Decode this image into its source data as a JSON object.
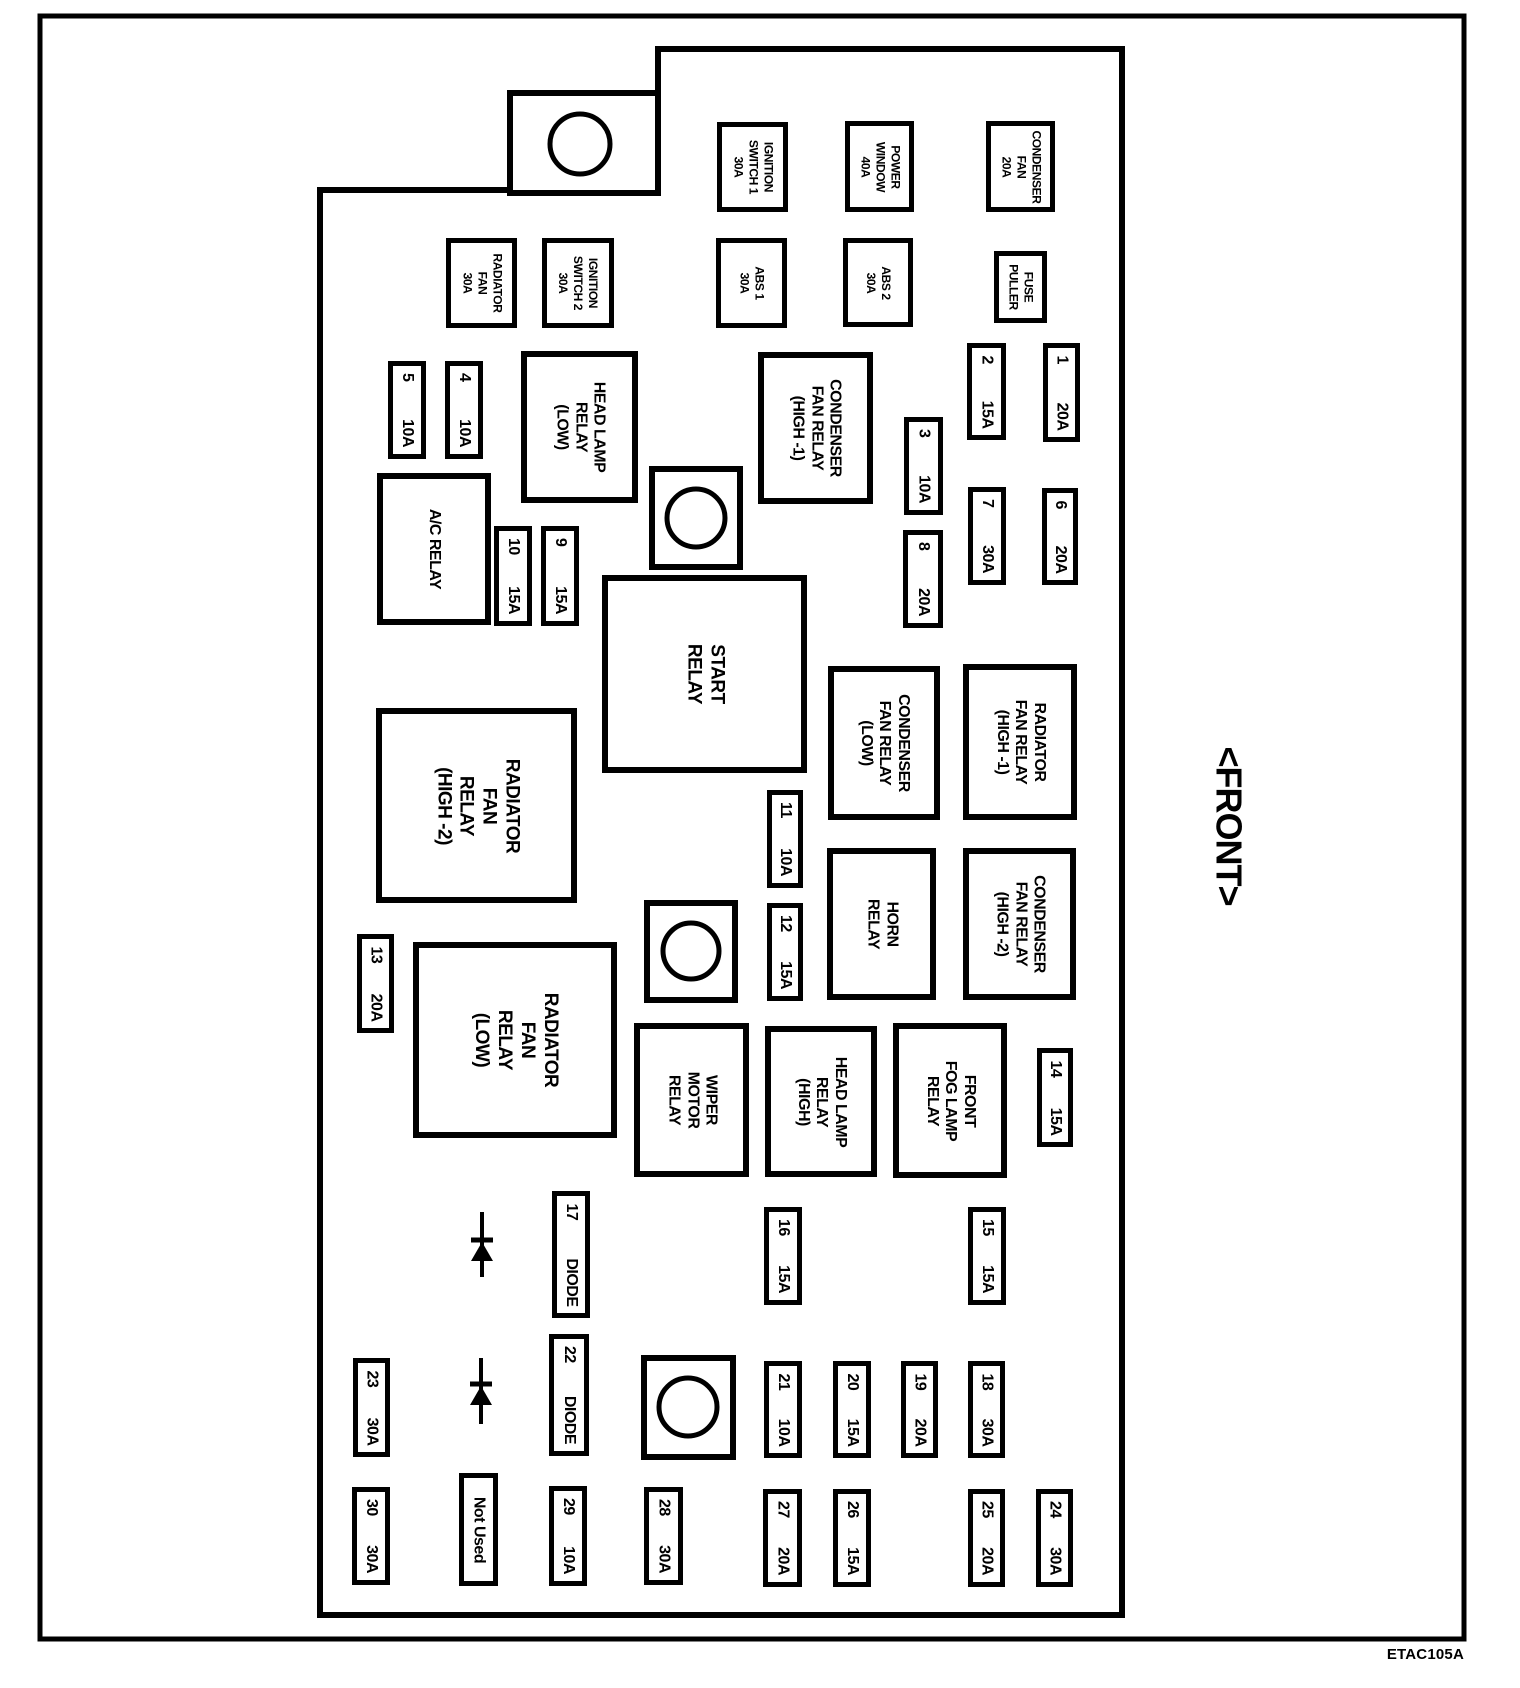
{
  "title_code": "ETAC105A",
  "front_label": "<FRONT>",
  "colors": {
    "ink": "#000000",
    "paper": "#ffffff"
  },
  "outline": {
    "outer": {
      "x": 40,
      "y": 16,
      "w": 1424,
      "h": 1623
    },
    "inner_points": "658,49 1122,49 1122,1615 320,1615 320,190 658,190",
    "tab": {
      "x": 510,
      "y": 93,
      "w": 148,
      "h": 100
    }
  },
  "holes": [
    {
      "name": "mounting-tab-hole",
      "sq": {
        "x": 510,
        "y": 93,
        "w": 148,
        "h": 100
      },
      "c": {
        "cx": 580,
        "cy": 144,
        "r": 30
      }
    },
    {
      "name": "mounting-hole-1",
      "sq": {
        "x": 652,
        "y": 469,
        "w": 88,
        "h": 98
      },
      "c": {
        "cx": 696,
        "cy": 518,
        "r": 29
      }
    },
    {
      "name": "mounting-hole-2",
      "sq": {
        "x": 647,
        "y": 903,
        "w": 88,
        "h": 97
      },
      "c": {
        "cx": 691,
        "cy": 951,
        "r": 28
      }
    },
    {
      "name": "mounting-hole-3",
      "sq": {
        "x": 644,
        "y": 1358,
        "w": 89,
        "h": 99
      },
      "c": {
        "cx": 688,
        "cy": 1407,
        "r": 29
      }
    }
  ],
  "diodes": [
    {
      "name": "diode-symbol-1",
      "cx": 482,
      "top": 1212,
      "bar": 1240,
      "tri": 19,
      "bottom": 1277,
      "half": 11
    },
    {
      "name": "diode-symbol-2",
      "cx": 481,
      "top": 1358,
      "bar": 1384,
      "tri": 19,
      "bottom": 1424,
      "half": 11
    }
  ],
  "components": [
    {
      "name": "ignition-switch-1",
      "x": 717,
      "y": 122,
      "w": 71,
      "h": 90,
      "lines": [
        "IGNITION",
        "SWITCH 1",
        "30A"
      ]
    },
    {
      "name": "power-window",
      "x": 845,
      "y": 121,
      "w": 69,
      "h": 91,
      "lines": [
        "POWER",
        "WINDOW",
        "40A"
      ]
    },
    {
      "name": "condenser-fan",
      "x": 986,
      "y": 121,
      "w": 69,
      "h": 91,
      "lines": [
        "CONDENSER",
        "FAN",
        "20A"
      ]
    },
    {
      "name": "radiator-fan",
      "x": 446,
      "y": 238,
      "w": 71,
      "h": 90,
      "lines": [
        "RADIATOR",
        "FAN",
        "30A"
      ]
    },
    {
      "name": "ignition-switch-2",
      "x": 542,
      "y": 238,
      "w": 72,
      "h": 90,
      "lines": [
        "IGNITION",
        "SWITCH 2",
        "30A"
      ]
    },
    {
      "name": "abs-1",
      "x": 716,
      "y": 238,
      "w": 71,
      "h": 90,
      "lines": [
        "ABS 1",
        "30A"
      ]
    },
    {
      "name": "abs-2",
      "x": 843,
      "y": 238,
      "w": 70,
      "h": 89,
      "lines": [
        "ABS 2",
        "30A"
      ]
    },
    {
      "name": "fuse-puller",
      "x": 994,
      "y": 251,
      "w": 53,
      "h": 72,
      "lines": [
        "FUSE",
        "PULLER"
      ]
    }
  ],
  "relays": [
    {
      "name": "head-lamp-relay-low",
      "x": 521,
      "y": 351,
      "w": 117,
      "h": 152,
      "size": "md",
      "lines": [
        "HEAD LAMP",
        "RELAY",
        "(LOW)"
      ]
    },
    {
      "name": "condenser-fan-relay-high-1",
      "x": 758,
      "y": 352,
      "w": 115,
      "h": 152,
      "size": "md",
      "lines": [
        "CONDENSER",
        "FAN RELAY",
        "(HIGH -1)"
      ]
    },
    {
      "name": "ac-relay",
      "x": 377,
      "y": 473,
      "w": 114,
      "h": 152,
      "size": "md",
      "lines": [
        "A/C RELAY"
      ]
    },
    {
      "name": "start-relay",
      "x": 602,
      "y": 575,
      "w": 205,
      "h": 198,
      "size": "lg",
      "lines": [
        "START",
        "RELAY"
      ]
    },
    {
      "name": "radiator-fan-relay-high-2",
      "x": 376,
      "y": 708,
      "w": 201,
      "h": 195,
      "size": "lg",
      "lines": [
        "RADIATOR",
        "FAN",
        "RELAY",
        "(HIGH -2)"
      ]
    },
    {
      "name": "condenser-fan-relay-low",
      "x": 828,
      "y": 666,
      "w": 112,
      "h": 154,
      "size": "md",
      "lines": [
        "CONDENSER",
        "FAN RELAY",
        "(LOW)"
      ]
    },
    {
      "name": "radiator-fan-relay-high-1",
      "x": 963,
      "y": 664,
      "w": 114,
      "h": 156,
      "size": "md",
      "lines": [
        "RADIATOR",
        "FAN RELAY",
        "(HIGH -1)"
      ]
    },
    {
      "name": "horn-relay",
      "x": 827,
      "y": 848,
      "w": 109,
      "h": 152,
      "size": "md",
      "lines": [
        "HORN",
        "RELAY"
      ]
    },
    {
      "name": "condenser-fan-relay-high-2",
      "x": 963,
      "y": 848,
      "w": 113,
      "h": 152,
      "size": "md",
      "lines": [
        "CONDENSER",
        "FAN RELAY",
        "(HIGH -2)"
      ]
    },
    {
      "name": "radiator-fan-relay-low",
      "x": 413,
      "y": 942,
      "w": 204,
      "h": 196,
      "size": "lg",
      "lines": [
        "RADIATOR",
        "FAN",
        "RELAY",
        "(LOW)"
      ]
    },
    {
      "name": "wiper-motor-relay",
      "x": 634,
      "y": 1023,
      "w": 115,
      "h": 154,
      "size": "md",
      "lines": [
        "WIPER",
        "MOTOR",
        "RELAY"
      ]
    },
    {
      "name": "head-lamp-relay-high",
      "x": 765,
      "y": 1026,
      "w": 112,
      "h": 151,
      "size": "md",
      "lines": [
        "HEAD LAMP",
        "RELAY",
        "(HIGH)"
      ]
    },
    {
      "name": "front-fog-lamp-relay",
      "x": 893,
      "y": 1023,
      "w": 114,
      "h": 155,
      "size": "md",
      "lines": [
        "FRONT",
        "FOG LAMP",
        "RELAY"
      ]
    }
  ],
  "fuses": [
    {
      "name": "fuse-5",
      "x": 388,
      "y": 361,
      "w": 38,
      "h": 98,
      "parts": [
        "5",
        "10A"
      ]
    },
    {
      "name": "fuse-4",
      "x": 445,
      "y": 361,
      "w": 38,
      "h": 98,
      "parts": [
        "4",
        "10A"
      ]
    },
    {
      "name": "fuse-2",
      "x": 967,
      "y": 343,
      "w": 39,
      "h": 97,
      "parts": [
        "2",
        "15A"
      ]
    },
    {
      "name": "fuse-1",
      "x": 1043,
      "y": 343,
      "w": 37,
      "h": 99,
      "parts": [
        "1",
        "20A"
      ]
    },
    {
      "name": "fuse-3",
      "x": 904,
      "y": 417,
      "w": 39,
      "h": 98,
      "parts": [
        "3",
        "10A"
      ]
    },
    {
      "name": "fuse-7",
      "x": 968,
      "y": 487,
      "w": 38,
      "h": 98,
      "parts": [
        "7",
        "30A"
      ]
    },
    {
      "name": "fuse-6",
      "x": 1042,
      "y": 488,
      "w": 36,
      "h": 97,
      "parts": [
        "6",
        "20A"
      ]
    },
    {
      "name": "fuse-8",
      "x": 903,
      "y": 530,
      "w": 40,
      "h": 98,
      "parts": [
        "8",
        "20A"
      ]
    },
    {
      "name": "fuse-10",
      "x": 494,
      "y": 526,
      "w": 38,
      "h": 100,
      "parts": [
        "10",
        "15A"
      ]
    },
    {
      "name": "fuse-9",
      "x": 541,
      "y": 526,
      "w": 38,
      "h": 100,
      "parts": [
        "9",
        "15A"
      ]
    },
    {
      "name": "fuse-11",
      "x": 767,
      "y": 790,
      "w": 36,
      "h": 98,
      "parts": [
        "11",
        "10A"
      ]
    },
    {
      "name": "fuse-12",
      "x": 767,
      "y": 903,
      "w": 36,
      "h": 98,
      "parts": [
        "12",
        "15A"
      ]
    },
    {
      "name": "fuse-13",
      "x": 357,
      "y": 934,
      "w": 37,
      "h": 99,
      "parts": [
        "13",
        "20A"
      ]
    },
    {
      "name": "fuse-14",
      "x": 1037,
      "y": 1048,
      "w": 36,
      "h": 99,
      "parts": [
        "14",
        "15A"
      ]
    },
    {
      "name": "fuse-16",
      "x": 764,
      "y": 1207,
      "w": 38,
      "h": 98,
      "parts": [
        "16",
        "15A"
      ]
    },
    {
      "name": "fuse-15",
      "x": 968,
      "y": 1207,
      "w": 38,
      "h": 98,
      "parts": [
        "15",
        "15A"
      ]
    },
    {
      "name": "fuse-17",
      "x": 552,
      "y": 1191,
      "w": 38,
      "h": 127,
      "parts": [
        "17",
        "DIODE"
      ]
    },
    {
      "name": "fuse-22",
      "x": 549,
      "y": 1334,
      "w": 40,
      "h": 122,
      "parts": [
        "22",
        "DIODE"
      ]
    },
    {
      "name": "fuse-23",
      "x": 353,
      "y": 1358,
      "w": 37,
      "h": 99,
      "parts": [
        "23",
        "30A"
      ]
    },
    {
      "name": "fuse-21",
      "x": 764,
      "y": 1361,
      "w": 38,
      "h": 97,
      "parts": [
        "21",
        "10A"
      ]
    },
    {
      "name": "fuse-20",
      "x": 833,
      "y": 1361,
      "w": 38,
      "h": 97,
      "parts": [
        "20",
        "15A"
      ]
    },
    {
      "name": "fuse-19",
      "x": 901,
      "y": 1361,
      "w": 37,
      "h": 97,
      "parts": [
        "19",
        "20A"
      ]
    },
    {
      "name": "fuse-18",
      "x": 968,
      "y": 1361,
      "w": 37,
      "h": 97,
      "parts": [
        "18",
        "30A"
      ]
    },
    {
      "name": "fuse-30",
      "x": 352,
      "y": 1487,
      "w": 38,
      "h": 98,
      "parts": [
        "30",
        "30A"
      ]
    },
    {
      "name": "fuse-not-used",
      "x": 459,
      "y": 1473,
      "w": 39,
      "h": 113,
      "parts": [
        "Not Used"
      ]
    },
    {
      "name": "fuse-29",
      "x": 549,
      "y": 1486,
      "w": 38,
      "h": 100,
      "parts": [
        "29",
        "10A"
      ]
    },
    {
      "name": "fuse-28",
      "x": 644,
      "y": 1487,
      "w": 39,
      "h": 98,
      "parts": [
        "28",
        "30A"
      ]
    },
    {
      "name": "fuse-27",
      "x": 763,
      "y": 1489,
      "w": 39,
      "h": 98,
      "parts": [
        "27",
        "20A"
      ]
    },
    {
      "name": "fuse-26",
      "x": 833,
      "y": 1489,
      "w": 38,
      "h": 98,
      "parts": [
        "26",
        "15A"
      ]
    },
    {
      "name": "fuse-25",
      "x": 968,
      "y": 1489,
      "w": 37,
      "h": 98,
      "parts": [
        "25",
        "20A"
      ]
    },
    {
      "name": "fuse-24",
      "x": 1036,
      "y": 1489,
      "w": 37,
      "h": 98,
      "parts": [
        "24",
        "30A"
      ]
    }
  ],
  "front_pos": {
    "x": 1199,
    "y": 731,
    "w": 60,
    "h": 190
  },
  "code_pos": {
    "left": 1320,
    "top": 1646,
    "width": 144
  }
}
